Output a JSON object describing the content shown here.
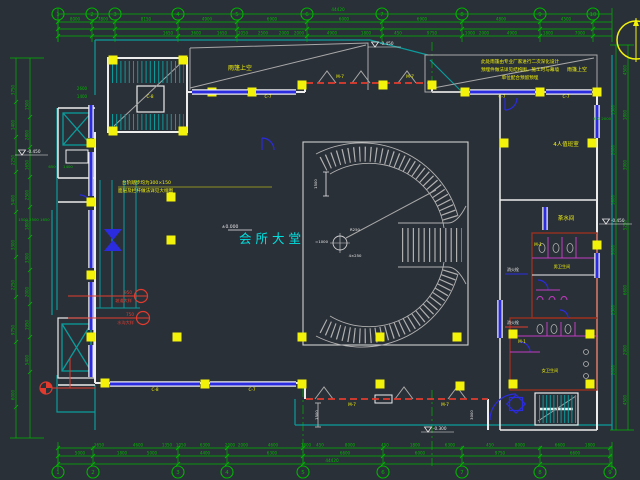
{
  "drawing": {
    "main_room_label": "会所大堂",
    "total_dim_top": "44420",
    "total_dim_bottom": "44420"
  },
  "palette": {
    "bg": "#2a3038",
    "green": "#00b400",
    "teal": "#0a9c9c",
    "cyan": "#00e0e0",
    "yellow": "#f2f20a",
    "blue": "#2b2bdf",
    "white": "#ececec",
    "gray": "#a8a8a8",
    "red": "#e23b2e",
    "darkred": "#96301f",
    "magenta": "#c23bc2"
  },
  "axis": {
    "top": [
      {
        "x": 58,
        "l": "1"
      },
      {
        "x": 92,
        "l": "2"
      },
      {
        "x": 115,
        "l": "3"
      },
      {
        "x": 178,
        "l": "4"
      },
      {
        "x": 237,
        "l": "5"
      },
      {
        "x": 307,
        "l": "6"
      },
      {
        "x": 382,
        "l": "7"
      },
      {
        "x": 462,
        "l": "8"
      },
      {
        "x": 540,
        "l": "9"
      },
      {
        "x": 593,
        "l": "10"
      }
    ],
    "bottom": [
      {
        "x": 58,
        "l": "1"
      },
      {
        "x": 93,
        "l": "2"
      },
      {
        "x": 178,
        "l": "3"
      },
      {
        "x": 227,
        "l": "4"
      },
      {
        "x": 303,
        "l": "5"
      },
      {
        "x": 383,
        "l": "6"
      },
      {
        "x": 462,
        "l": "7"
      },
      {
        "x": 540,
        "l": "8"
      },
      {
        "x": 610,
        "l": "9"
      }
    ]
  },
  "dims": {
    "top1": [
      {
        "x": 75,
        "t": "8000"
      },
      {
        "x": 103,
        "t": "7800"
      },
      {
        "x": 146,
        "t": "8150"
      },
      {
        "x": 207,
        "t": "4900"
      },
      {
        "x": 272,
        "t": "6900"
      },
      {
        "x": 344,
        "t": "6000"
      },
      {
        "x": 422,
        "t": "6900"
      },
      {
        "x": 501,
        "t": "4800"
      },
      {
        "x": 566,
        "t": "4500"
      }
    ],
    "top2": [
      {
        "x": 168,
        "t": "1650"
      },
      {
        "x": 196,
        "t": "3600"
      },
      {
        "x": 222,
        "t": "1650"
      },
      {
        "x": 243,
        "t": "1050"
      },
      {
        "x": 263,
        "t": "2500"
      },
      {
        "x": 284,
        "t": "2000"
      },
      {
        "x": 299,
        "t": "2000"
      },
      {
        "x": 332,
        "t": "4900"
      },
      {
        "x": 366,
        "t": "1800"
      },
      {
        "x": 398,
        "t": "450"
      },
      {
        "x": 432,
        "t": "9750"
      },
      {
        "x": 470,
        "t": "1000"
      },
      {
        "x": 484,
        "t": "2000"
      },
      {
        "x": 512,
        "t": "4900"
      },
      {
        "x": 548,
        "t": "1800"
      },
      {
        "x": 580,
        "t": "7000"
      }
    ],
    "bottom1": [
      {
        "x": 99,
        "t": "1650"
      },
      {
        "x": 138,
        "t": "4600"
      },
      {
        "x": 167,
        "t": "1350"
      },
      {
        "x": 181,
        "t": "1050"
      },
      {
        "x": 205,
        "t": "6300"
      },
      {
        "x": 230,
        "t": "2000"
      },
      {
        "x": 243,
        "t": "2000"
      },
      {
        "x": 273,
        "t": "4600"
      },
      {
        "x": 306,
        "t": "1800"
      },
      {
        "x": 320,
        "t": "450"
      },
      {
        "x": 350,
        "t": "8000"
      },
      {
        "x": 385,
        "t": "450"
      },
      {
        "x": 415,
        "t": "1800"
      },
      {
        "x": 450,
        "t": "6300"
      },
      {
        "x": 490,
        "t": "450"
      },
      {
        "x": 520,
        "t": "8000"
      },
      {
        "x": 560,
        "t": "6600"
      },
      {
        "x": 590,
        "t": "1800"
      }
    ],
    "bottom2": [
      {
        "x": 80,
        "t": "5000"
      },
      {
        "x": 122,
        "t": "1800"
      },
      {
        "x": 152,
        "t": "5000"
      },
      {
        "x": 205,
        "t": "4400"
      },
      {
        "x": 272,
        "t": "6300"
      },
      {
        "x": 345,
        "t": "6600"
      },
      {
        "x": 420,
        "t": "6000"
      },
      {
        "x": 500,
        "t": "9750"
      },
      {
        "x": 575,
        "t": "6600"
      }
    ],
    "left": [
      {
        "y": 90,
        "t": "3750"
      },
      {
        "y": 125,
        "t": "1400"
      },
      {
        "y": 160,
        "t": "2250"
      },
      {
        "y": 200,
        "t": "5400"
      },
      {
        "y": 245,
        "t": "3300"
      },
      {
        "y": 285,
        "t": "2250"
      },
      {
        "y": 330,
        "t": "9750"
      },
      {
        "y": 395,
        "t": "6000"
      }
    ],
    "left2": [
      {
        "y": 105,
        "t": "1500"
      },
      {
        "y": 135,
        "t": "2800"
      },
      {
        "y": 165,
        "t": "1650"
      },
      {
        "y": 195,
        "t": "2500"
      },
      {
        "y": 225,
        "t": "1800"
      },
      {
        "y": 258,
        "t": "3300"
      },
      {
        "y": 292,
        "t": "2000"
      },
      {
        "y": 325,
        "t": "1950"
      },
      {
        "y": 360,
        "t": "5400"
      }
    ],
    "right": [
      {
        "y": 70,
        "t": "4500"
      },
      {
        "y": 115,
        "t": "1800"
      },
      {
        "y": 165,
        "t": "3900"
      },
      {
        "y": 225,
        "t": "5250"
      },
      {
        "y": 290,
        "t": "6600"
      },
      {
        "y": 350,
        "t": "2900"
      },
      {
        "y": 400,
        "t": "4500"
      }
    ],
    "right2": [
      {
        "y": 110,
        "t": "1500"
      },
      {
        "y": 150,
        "t": "2000"
      },
      {
        "y": 200,
        "t": "1800"
      },
      {
        "y": 250,
        "t": "3000"
      },
      {
        "y": 310,
        "t": "2500"
      },
      {
        "y": 370,
        "t": "2000"
      }
    ],
    "singles": [
      {
        "x": 338,
        "y": 11,
        "t": "44420"
      },
      {
        "x": 332,
        "y": 462,
        "t": "44420"
      }
    ]
  },
  "columns": [
    [
      113,
      60
    ],
    [
      183,
      60
    ],
    [
      113,
      131
    ],
    [
      183,
      131
    ],
    [
      212,
      92
    ],
    [
      252,
      92
    ],
    [
      302,
      85
    ],
    [
      383,
      85
    ],
    [
      432,
      85
    ],
    [
      465,
      92
    ],
    [
      540,
      92
    ],
    [
      597,
      92
    ],
    [
      91,
      143
    ],
    [
      91,
      202
    ],
    [
      91,
      275
    ],
    [
      91,
      337
    ],
    [
      171,
      197
    ],
    [
      171,
      240
    ],
    [
      177,
      337
    ],
    [
      302,
      337
    ],
    [
      380,
      337
    ],
    [
      457,
      337
    ],
    [
      105,
      383
    ],
    [
      205,
      384
    ],
    [
      302,
      384
    ],
    [
      380,
      384
    ],
    [
      460,
      386
    ],
    [
      504,
      143
    ],
    [
      592,
      143
    ],
    [
      597,
      245
    ],
    [
      513,
      334
    ],
    [
      590,
      334
    ],
    [
      513,
      384
    ],
    [
      590,
      384
    ]
  ],
  "windows": [
    [
      91,
      105,
      91,
      138
    ],
    [
      91,
      152,
      91,
      196
    ],
    [
      91,
      210,
      91,
      268
    ],
    [
      91,
      282,
      91,
      330
    ],
    [
      91,
      345,
      91,
      377
    ],
    [
      192,
      92,
      248,
      92
    ],
    [
      256,
      92,
      296,
      92
    ],
    [
      470,
      92,
      535,
      92
    ],
    [
      546,
      92,
      592,
      92
    ],
    [
      110,
      384,
      200,
      384
    ],
    [
      210,
      384,
      296,
      384
    ],
    [
      597,
      105,
      597,
      138
    ],
    [
      597,
      253,
      597,
      278
    ],
    [
      500,
      300,
      500,
      338
    ],
    [
      545,
      207,
      545,
      230
    ]
  ],
  "tags": [
    {
      "x": 150,
      "y": 98,
      "t": "C-8"
    },
    {
      "x": 268,
      "y": 98,
      "t": "C-7"
    },
    {
      "x": 502,
      "y": 98,
      "t": "C-7"
    },
    {
      "x": 566,
      "y": 98,
      "t": "C-7"
    },
    {
      "x": 155,
      "y": 391,
      "t": "C-8"
    },
    {
      "x": 252,
      "y": 391,
      "t": "C-7"
    },
    {
      "x": 340,
      "y": 78,
      "t": "M-7"
    },
    {
      "x": 410,
      "y": 78,
      "t": "M-7"
    },
    {
      "x": 352,
      "y": 406,
      "t": "M-7"
    },
    {
      "x": 445,
      "y": 406,
      "t": "M-7"
    },
    {
      "x": 538,
      "y": 246,
      "t": "M-1"
    },
    {
      "x": 522,
      "y": 343,
      "t": "M-1"
    }
  ],
  "labels": [
    {
      "x": 272,
      "y": 243,
      "t": "会所大堂",
      "c": "cyan",
      "s": 12.5,
      "ls": 4
    },
    {
      "x": 240,
      "y": 70,
      "t": "雨篷上空",
      "c": "yellow",
      "s": 6
    },
    {
      "x": 577,
      "y": 71,
      "t": "雨篷上空",
      "c": "yellow",
      "s": 5
    },
    {
      "x": 520,
      "y": 63,
      "t": "此处雨篷由专业厂家进行二次深化设计",
      "c": "yellow",
      "s": 4.6
    },
    {
      "x": 520,
      "y": 71,
      "t": "预埋件做法详见结构图，施工时与幕墙",
      "c": "yellow",
      "s": 4.6
    },
    {
      "x": 520,
      "y": 79,
      "t": "单位配合预留预埋",
      "c": "yellow",
      "s": 4.6
    },
    {
      "x": 566,
      "y": 146,
      "t": "4人值班室",
      "c": "yellow",
      "s": 5.5
    },
    {
      "x": 566,
      "y": 220,
      "t": "茶水间",
      "c": "yellow",
      "s": 5.5
    },
    {
      "x": 562,
      "y": 268,
      "t": "男卫生间",
      "c": "yellow",
      "s": 4.2
    },
    {
      "x": 550,
      "y": 372,
      "t": "女卫生间",
      "c": "yellow",
      "s": 4.2
    },
    {
      "x": 122,
      "y": 184,
      "t": "台阶踏步均为300×150",
      "c": "yellow",
      "s": 4.6,
      "a": "start"
    },
    {
      "x": 118,
      "y": 192,
      "t": "面层及栏杆做法详见大样图",
      "c": "yellow",
      "s": 4.6,
      "a": "start"
    }
  ],
  "misc_texts": [
    {
      "x": 82,
      "y": 90,
      "t": "2600",
      "c": "green",
      "s": 4
    },
    {
      "x": 82,
      "y": 98,
      "t": "1400",
      "c": "green",
      "s": 4
    },
    {
      "x": 52,
      "y": 168,
      "t": "650",
      "c": "green",
      "s": 3.8
    },
    {
      "x": 68,
      "y": 168,
      "t": "1400",
      "c": "green",
      "s": 3.8
    },
    {
      "x": 34,
      "y": 221,
      "t": "1500 2500 1650",
      "c": "green",
      "s": 3.8
    },
    {
      "x": 602,
      "y": 120,
      "t": "900 2000",
      "c": "green",
      "s": 3.8
    },
    {
      "x": 317,
      "y": 184,
      "t": "1500",
      "c": "white",
      "s": 3.8,
      "r": -90
    },
    {
      "x": 355,
      "y": 231,
      "t": "R250",
      "c": "white",
      "s": 3.8
    },
    {
      "x": 355,
      "y": 257,
      "t": "4×250",
      "c": "white",
      "s": 3.8
    },
    {
      "x": 328,
      "y": 243,
      "t": "=1000",
      "c": "white",
      "s": 3.8,
      "a": "end"
    },
    {
      "x": 513,
      "y": 324,
      "t": "消火栓",
      "c": "white",
      "s": 4
    },
    {
      "x": 513,
      "y": 271,
      "t": "消火栓",
      "c": "white",
      "s": 4
    },
    {
      "x": 318,
      "y": 415,
      "t": "1500",
      "c": "white",
      "s": 3.8,
      "r": -90
    },
    {
      "x": 473,
      "y": 415,
      "t": "3000",
      "c": "white",
      "s": 3.8,
      "r": -90
    },
    {
      "x": 230,
      "y": 228,
      "t": "±0.000",
      "c": "white",
      "s": 4.5
    }
  ],
  "levels": [
    {
      "x": 375,
      "y": 47,
      "t": "-0.450"
    },
    {
      "x": 22,
      "y": 155,
      "t": "-0.450"
    },
    {
      "x": 428,
      "y": 432,
      "t": "-0.300"
    },
    {
      "x": 606,
      "y": 224,
      "t": "-0.450"
    }
  ],
  "callouts": [
    {
      "lx": 68,
      "y": 296,
      "cx": 141,
      "t1": "950",
      "t2": "坡道大样"
    },
    {
      "lx": 68,
      "y": 318,
      "cx": 143,
      "t1": "750",
      "t2": "水沟大样"
    }
  ]
}
